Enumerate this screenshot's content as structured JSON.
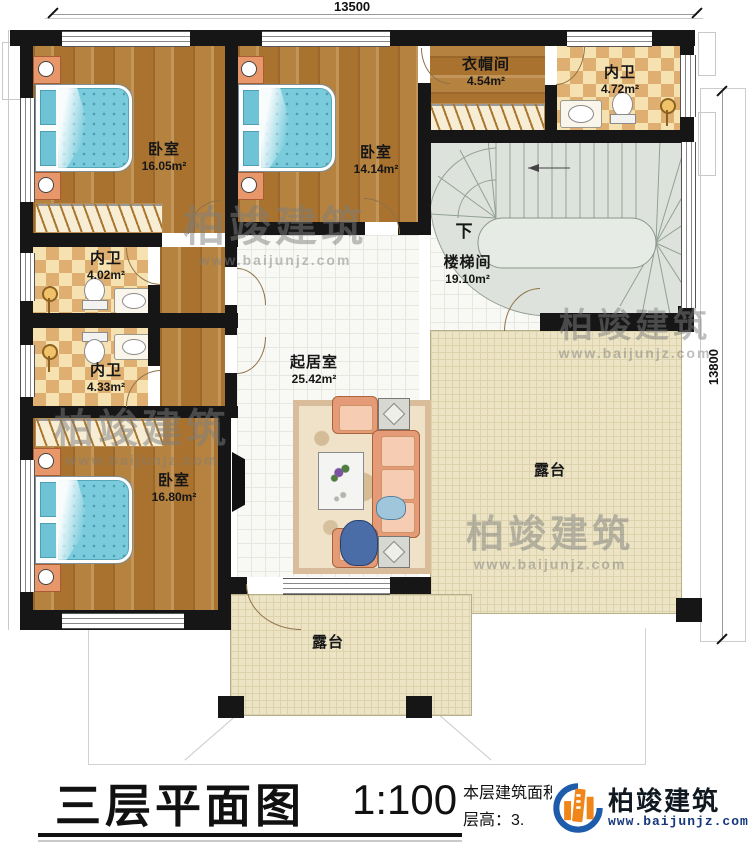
{
  "dimensions": {
    "top": "13500",
    "right": "13800"
  },
  "rooms": {
    "bedroom1": {
      "name": "卧室",
      "area": "16.05m²"
    },
    "bedroom2": {
      "name": "卧室",
      "area": "14.14m²"
    },
    "cloakroom": {
      "name": "衣帽间",
      "area": "4.54m²"
    },
    "bath_top": {
      "name": "内卫",
      "area": "4.72m²"
    },
    "stairwell": {
      "name": "楼梯间",
      "area": "19.10m²",
      "down": "下"
    },
    "bath_mid": {
      "name": "内卫",
      "area": "4.02m²"
    },
    "bath_low": {
      "name": "内卫",
      "area": "4.33m²"
    },
    "bedroom3": {
      "name": "卧室",
      "area": "16.80m²"
    },
    "living": {
      "name": "起居室",
      "area": "25.42m²"
    },
    "terrace_right": {
      "name": "露台"
    },
    "terrace_bottom": {
      "name": "露台"
    }
  },
  "titleblock": {
    "title": "三层平面图",
    "scale": "1:100",
    "line1": "本层建筑面积：",
    "line2": "层高：3."
  },
  "watermark": {
    "text": "柏竣建筑",
    "url": "www.baijunjz.com"
  },
  "logo": {
    "name": "柏竣建筑",
    "url": "www.baijunjz.com"
  }
}
